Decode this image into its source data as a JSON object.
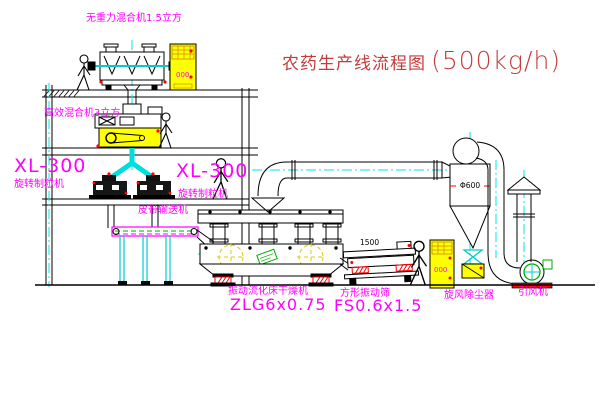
{
  "title": {
    "name": "农药生产线流程图",
    "capacity": "(500kg/h)"
  },
  "equipment_labels": {
    "gravity_mixer": "无重力混合机1.5立方",
    "high_eff_mixer": "高效混合机3立方",
    "granulator_left_model": "XL-300",
    "granulator_left_name": "旋转制粒机",
    "granulator_mid_model": "XL-300",
    "granulator_mid_name": "旋转制粒机",
    "belt_conveyor": "皮带输送机",
    "dryer_name": "振动流化床干燥机",
    "dryer_model": "ZLG6x0.75",
    "sieve_name": "方形振动筛",
    "sieve_model": "FS0.6x1.5",
    "cyclone_name": "旋风除尘器",
    "fan_name": "引风机"
  },
  "dimensions": {
    "sieve_length": "1500",
    "cyclone_diameter": "Φ600"
  },
  "cabinet_display": "000",
  "colors": {
    "label_magenta": "#ff00ff",
    "title_red": "#c43b3b",
    "centerline_cyan": "#00e5e5",
    "cabinet_yellow": "#ffff00",
    "flowmark_yellow": "#ddcc00",
    "machine_green": "#00aa00",
    "alert_red": "#ff0000",
    "line_black": "#000000"
  }
}
